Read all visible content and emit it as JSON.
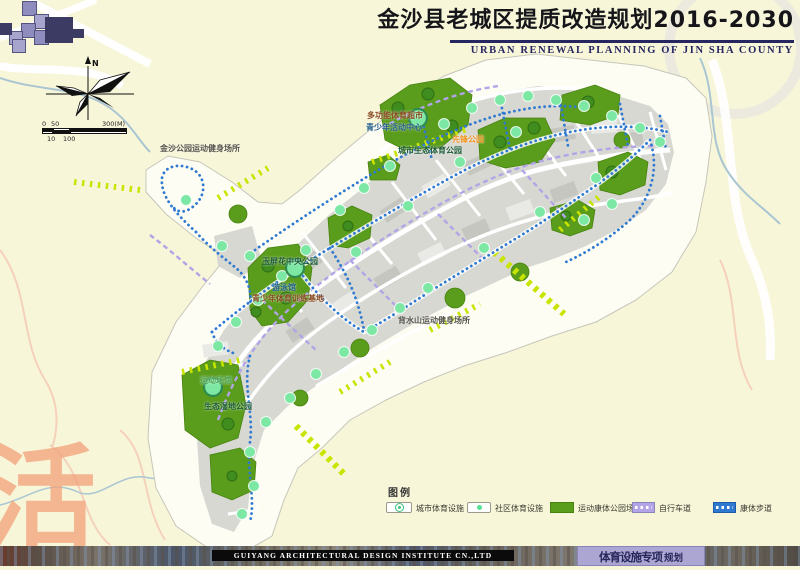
{
  "header": {
    "title": "金沙县老城区提质改造规划2016-2030",
    "subtitle": "URBAN RENEWAL PLANNING OF JIN SHA COUNTY"
  },
  "compass": {
    "north": "N"
  },
  "scale_bar": {
    "top": [
      "0",
      "50",
      "300(M)"
    ],
    "bottom": [
      "10",
      "100"
    ]
  },
  "map_labels": [
    {
      "text": "金沙公园运动健身场所",
      "color": "#55544a"
    },
    {
      "text": "多功能体育超市",
      "color": "#8a4a20"
    },
    {
      "text": "青少年活动中心",
      "color": "#22608c"
    },
    {
      "text": "先锋公园",
      "color": "#f0941e"
    },
    {
      "text": "城市生态体育公园",
      "color": "#1d5c38"
    },
    {
      "text": "玉屏花中央公园",
      "color": "#1d5c38"
    },
    {
      "text": "游泳馆",
      "color": "#22608c"
    },
    {
      "text": "青少年体育训练基地",
      "color": "#8a4a20"
    },
    {
      "text": "背水山运动健身场所",
      "color": "#55544a"
    },
    {
      "text": "运动场馆",
      "color": "#49a54f"
    },
    {
      "text": "生态湿地公园",
      "color": "#1d5c38"
    }
  ],
  "legend": {
    "title": "图例",
    "items": [
      {
        "label": "城市体育设施"
      },
      {
        "label": "社区体育设施"
      },
      {
        "label": "运动康体公园场地"
      },
      {
        "label": "自行车道"
      },
      {
        "label": "康体步道"
      }
    ]
  },
  "colors": {
    "park_green": "#5a9c1c",
    "facility_mint": "#57e093",
    "bike_lane_purple": "#b2a4e6",
    "fitness_trail_blue": "#2f7ad0",
    "greenway_chartreuse": "#c9e400",
    "title_navy": "#262660"
  },
  "footer": {
    "company": "GUIYANG ARCHITECTURAL DESIGN INSTITUTE CN.,LTD",
    "stamp_main": "体育设施专项",
    "stamp_suffix": "规划"
  },
  "watermark": "活"
}
